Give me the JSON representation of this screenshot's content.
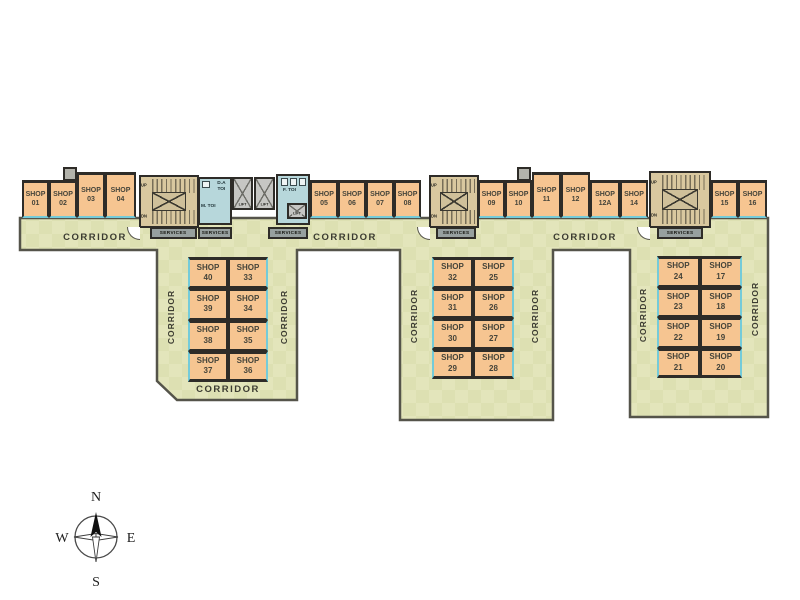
{
  "labels": {
    "shop": "SHOP",
    "corridor": "CORRIDOR",
    "services": "SERVICES",
    "up": "UP",
    "dn": "DN",
    "lift": "LIFT",
    "da_toilet": "D.A TOI",
    "m_toilet": "M. TOI",
    "f_toilet": "F. TOI"
  },
  "top_row": [
    "01",
    "02",
    "03",
    "04",
    "05",
    "06",
    "07",
    "08",
    "09",
    "10",
    "11",
    "12",
    "12A",
    "14",
    "15",
    "16"
  ],
  "wing1": [
    "40",
    "33",
    "39",
    "34",
    "38",
    "35",
    "37",
    "36"
  ],
  "wing2": [
    "32",
    "25",
    "31",
    "26",
    "30",
    "27",
    "29",
    "28"
  ],
  "wing3": [
    "24",
    "17",
    "23",
    "18",
    "22",
    "19",
    "21",
    "20"
  ],
  "compass": {
    "north": "N",
    "south": "S",
    "east": "E",
    "west": "W"
  },
  "colors": {
    "shop_fill": "#f6c591",
    "floor_fill": "#e3e5bb",
    "wall": "#2e2c28",
    "outline": "#55544a",
    "storefront_accent": "#74cbd9",
    "toilet_fill": "#b7d7db",
    "lift_fill": "#c6c6c3",
    "stair_fill": "#d9c89f",
    "services_fill": "#97a09f"
  }
}
